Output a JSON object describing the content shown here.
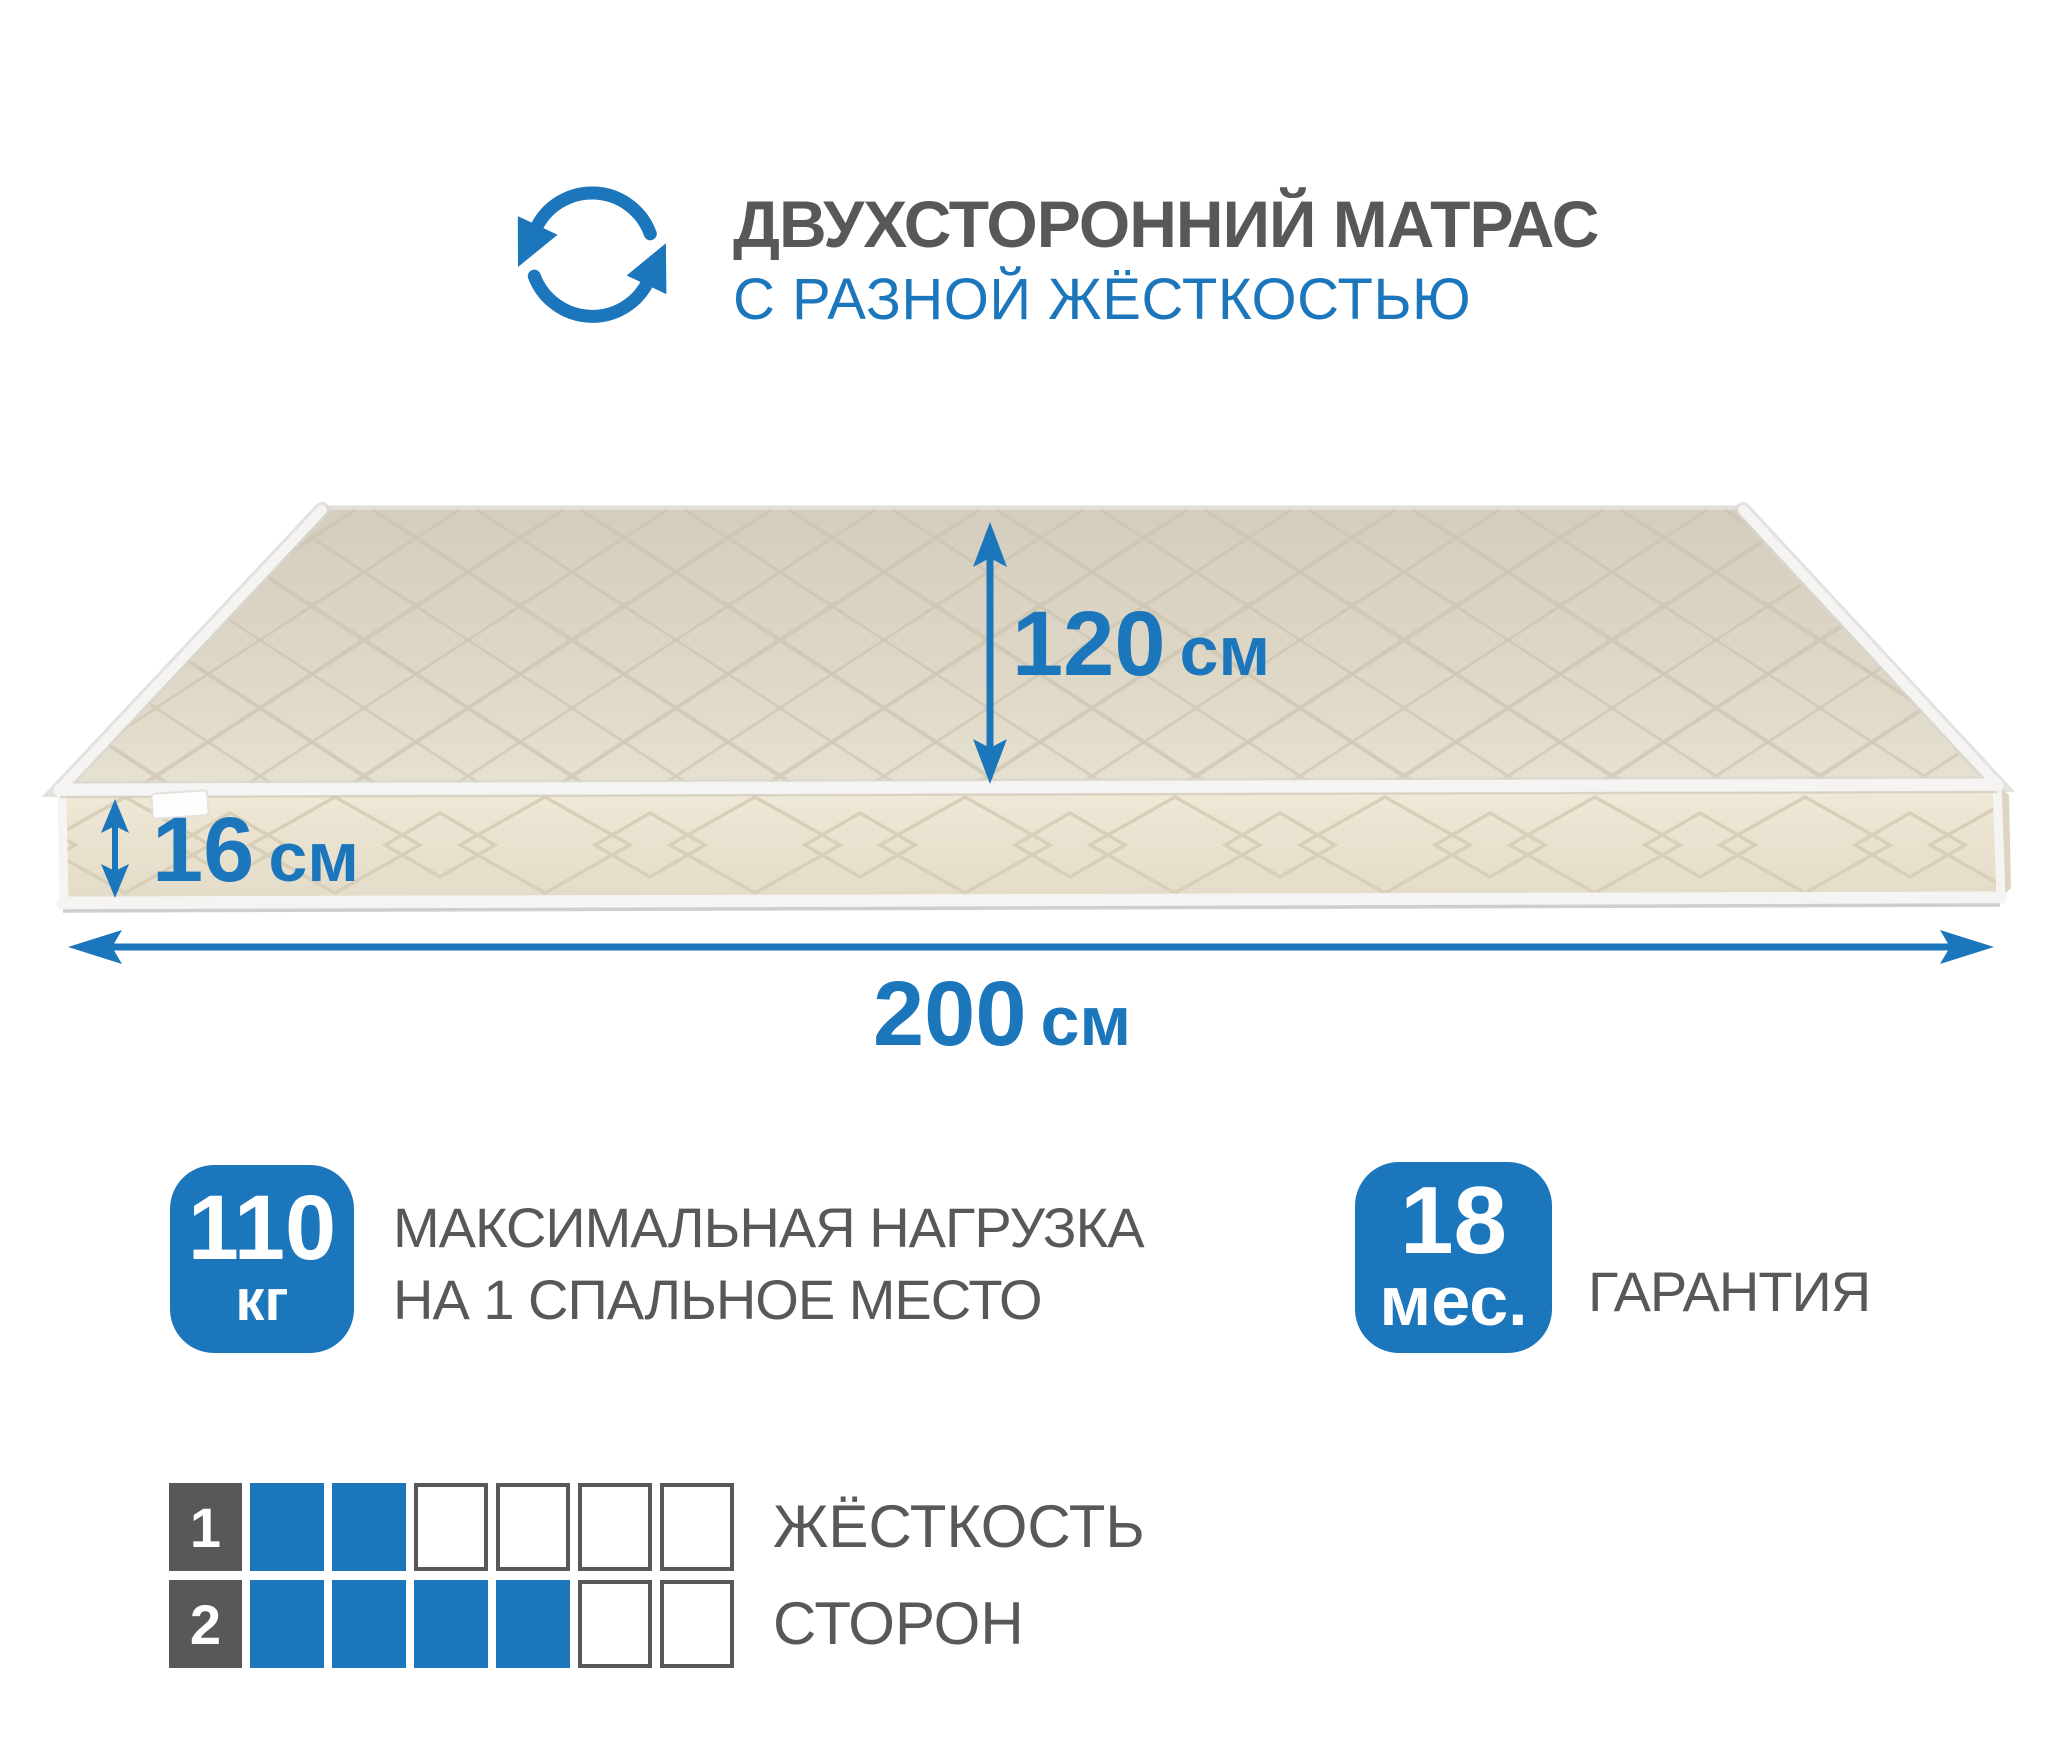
{
  "colors": {
    "accent_blue": "#1b76bc",
    "text_gray": "#58585a",
    "mattress_top": "#ddd6c5",
    "mattress_side": "#ece5d3",
    "piping_white": "#f5f4f2"
  },
  "header": {
    "icon": "rotate-arrows-icon",
    "title": "ДВУХСТОРОННИЙ МАТРАС",
    "subtitle": "С РАЗНОЙ ЖЁСТКОСТЬЮ"
  },
  "mattress": {
    "dimensions": {
      "depth": {
        "value": "120",
        "unit": "см"
      },
      "height": {
        "value": "16",
        "unit": "см"
      },
      "length": {
        "value": "200",
        "unit": "см"
      }
    }
  },
  "badges": {
    "max_load": {
      "value": "110",
      "unit": "кг",
      "label_line1": "МАКСИМАЛЬНАЯ НАГРУЗКА",
      "label_line2": "НА 1 СПАЛЬНОЕ МЕСТО"
    },
    "warranty": {
      "value": "18",
      "unit": "мес.",
      "label": "ГАРАНТИЯ"
    }
  },
  "firmness": {
    "label_line1": "ЖЁСТКОСТЬ",
    "label_line2": "СТОРОН",
    "scale_max": 6,
    "sides": [
      {
        "number": "1",
        "filled": 2
      },
      {
        "number": "2",
        "filled": 4
      }
    ]
  }
}
